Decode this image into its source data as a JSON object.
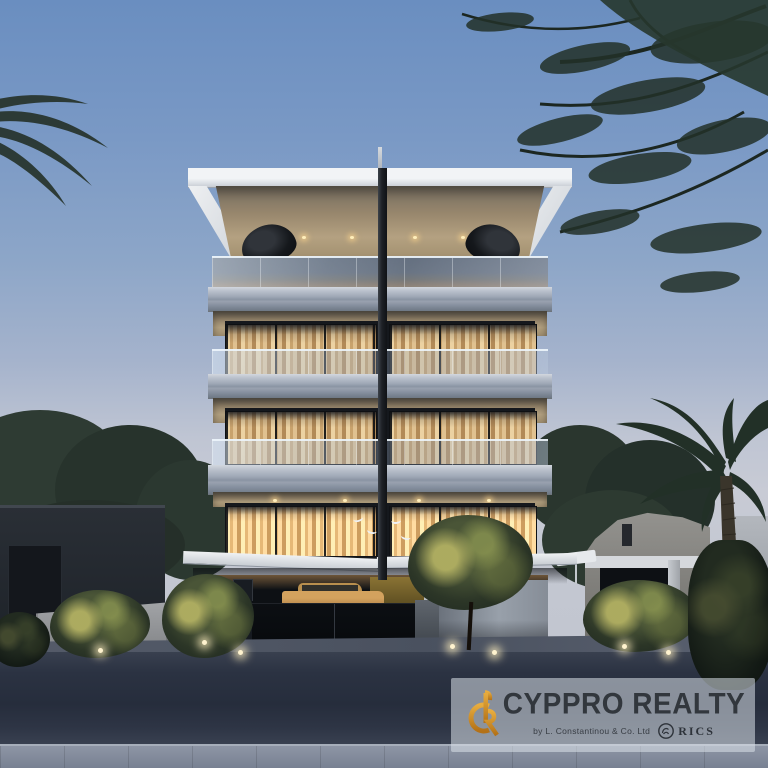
{
  "watermark": {
    "brand": "CYPPRO REALTY",
    "byline": "by L. Constantinou & Co. Ltd",
    "rics_label": "RICS"
  },
  "branding": {
    "logo_gold": "#d9952f",
    "logo_gold_dark": "#b37117",
    "brand_text_color": "#32373d",
    "panel_tint": "rgba(219,226,234,0.55)"
  },
  "scene_colors": {
    "sky_top": "#6a8ec0",
    "sky_horizon": "#c8cbd5",
    "window_glow": "#e8cd9b",
    "concrete_slab": "#9aa3b1",
    "soffit_wood": "#b2a07f",
    "foliage_dark": "#243129",
    "road_asphalt": "#2b3242",
    "sidewalk": "#7e8798",
    "car_paint": "#c89554",
    "accent_wall_olive": "#85702f"
  }
}
